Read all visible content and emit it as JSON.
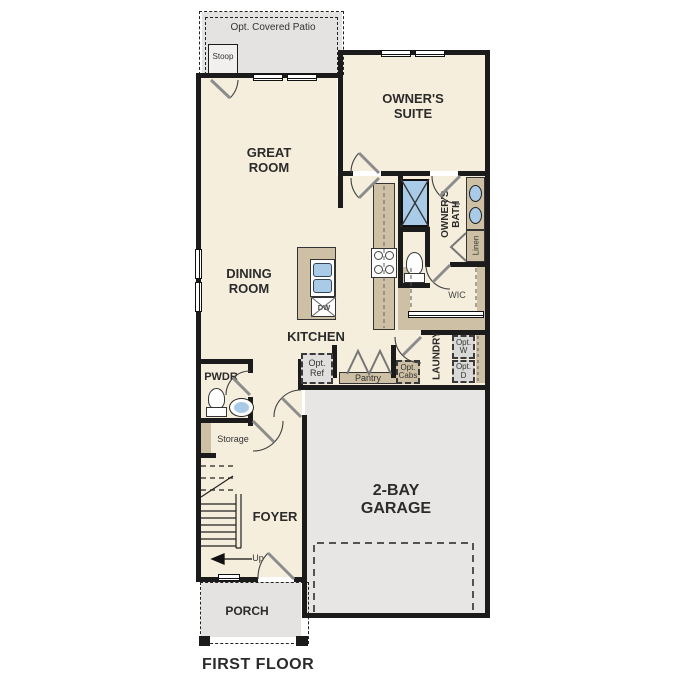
{
  "plan": {
    "title": "FIRST FLOOR",
    "labels": {
      "patio": "Opt. Covered Patio",
      "stoop": "Stoop",
      "great_room": "GREAT ROOM",
      "owners_suite": "OWNER'S SUITE",
      "dining_room": "DINING ROOM",
      "kitchen": "KITCHEN",
      "owners_bath": "OWNER'S BATH",
      "linen": "Linen",
      "wic": "WIC",
      "laundry": "LAUNDRY",
      "opt_washer": "Opt. W",
      "opt_dryer": "Opt. D",
      "opt_ref": "Opt. Ref",
      "opt_cabs": "Opt. Cabs",
      "pantry": "Pantry",
      "pwdr": "PWDR",
      "storage": "Storage",
      "foyer": "FOYER",
      "up": "Up",
      "garage": "2-BAY GARAGE",
      "porch": "PORCH",
      "dw": "DW"
    },
    "colors": {
      "room_fill": "#f6eedd",
      "outdoor_fill": "#e4e3e1",
      "garage_fill": "#e7e6e4",
      "cabinet_tan": "#cec0a4",
      "fixture_blue": "#a9cbe8",
      "wall": "#1b1b1b",
      "ink": "#2b2b2b"
    }
  }
}
